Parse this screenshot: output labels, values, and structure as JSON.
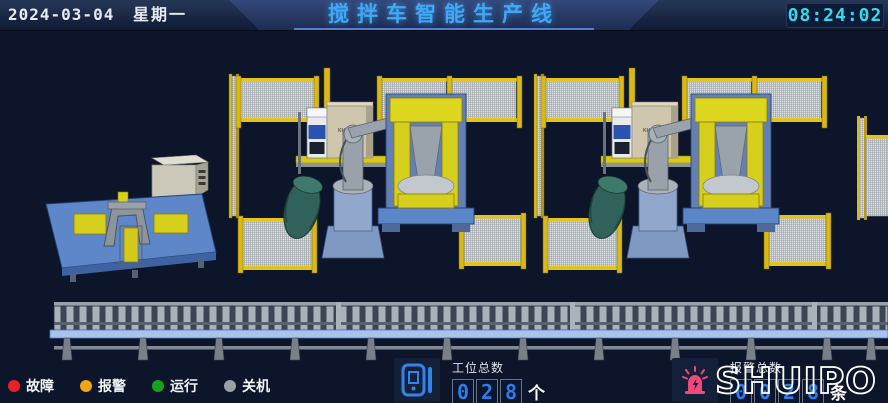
{
  "header": {
    "date": "2024-03-04",
    "weekday": "星期一",
    "title": "搅拌车智能生产线",
    "time": "08:24:02",
    "title_color": "#3fa9f5",
    "time_color": "#35d9ea"
  },
  "legend": {
    "items": [
      {
        "name": "fault",
        "label": "故障",
        "color": "#e8222b"
      },
      {
        "name": "alarm",
        "label": "报警",
        "color": "#f2a50f"
      },
      {
        "name": "running",
        "label": "运行",
        "color": "#16a21f"
      },
      {
        "name": "off",
        "label": "关机",
        "color": "#9aa0a6"
      }
    ]
  },
  "station_counter": {
    "icon": "counter-device-icon",
    "label": "工位总数",
    "digits": [
      "0",
      "2",
      "8"
    ],
    "value": "028",
    "unit": "个"
  },
  "alarm_counter": {
    "icon": "alarm-beacon-icon",
    "label": "报警总数",
    "digits": [
      "0",
      "0",
      "2",
      "8"
    ],
    "value": "0028",
    "unit": "条"
  },
  "logo": {
    "text": "SHUIPO"
  },
  "scene": {
    "type": "3d-production-line",
    "stations": [
      {
        "name": "fixture-station"
      },
      {
        "name": "robot-cell-1",
        "cabinet_label": "KUKA"
      },
      {
        "name": "robot-cell-2",
        "cabinet_label": "KUKA"
      }
    ],
    "conveyor": {
      "name": "roller-conveyor"
    },
    "colors": {
      "background": "#0c1529",
      "fence_frame": "#d9b916",
      "fence_mesh": "#dfe2e4",
      "robot_body": "#9aa2ac",
      "robot_base": "#8099c2",
      "positioner_yellow": "#d6cf1d",
      "machine_base_blue": "#5b86c8",
      "drum_green": "#30615a",
      "cabinet_beige": "#cfc7ad",
      "conveyor_rail_blue": "#a9c3ee"
    }
  }
}
